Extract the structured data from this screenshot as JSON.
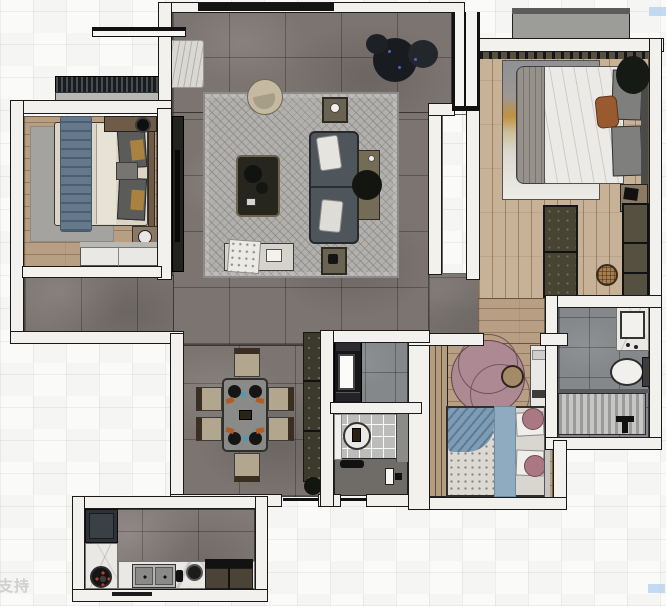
{
  "scene": {
    "type": "apartment floor plan render (top-down)",
    "watermark_text": "支持"
  },
  "colors": {
    "bg_base": "#fafaf9",
    "wall_fill": "#f2f1ee",
    "wall_line": "#1a1a1a",
    "floor_tile": "#7b7470",
    "wood_light": "#c7b298",
    "wood_mid": "#b89e82",
    "rug_gray": "#b2b0ad",
    "rug_bedroom": "#a5a3a0",
    "rug_pink": "#ad8a93",
    "sofa": "#4e565b",
    "bed_cream": "#dcd4c5",
    "bed_white": "#eceae6",
    "blue_textile": "#64798c",
    "blue_light": "#8fabc0",
    "pink_pillow": "#a97883",
    "orange_pillow": "#9a5a30",
    "dark_cabinet": "#22231f",
    "olive_cabinet": "#474433",
    "olive_light": "#55503f",
    "white_furniture": "#e9e8e4",
    "marble": "#eae8e4",
    "fridge": "#2c3237",
    "bath_tile": "#85888b",
    "tile_light": "#bcbcba",
    "shower_a": "#9a9a98",
    "shower_b": "#c6c6c4",
    "balcony": "#9c9c99",
    "plant_dark": "#191c1f",
    "headboard": "#6e5c48",
    "watermark": "#cbcbc9",
    "artifact_blue": "#b9d3ee"
  },
  "rooms": [
    {
      "id": "living-room",
      "floor": "gray marble tile",
      "items": [
        "tv-console",
        "curtain",
        "top-window",
        "herringbone-rug",
        "round-armchair",
        "coffee-table-with-plants",
        "sofa",
        "side-table-with-kettle",
        "side-table",
        "sofa-console",
        "floor-plant",
        "bench-with-throw"
      ]
    },
    {
      "id": "bedroom-left",
      "floor": "wood",
      "items": [
        "double-bed",
        "blue-throw",
        "gray-rug",
        "dark-pillows",
        "overhead-cabinet",
        "round-speaker",
        "nightstand-tray",
        "white-wardrobe",
        "balcony-planter",
        "balcony-slab",
        "window-bar"
      ]
    },
    {
      "id": "bedroom-right",
      "floor": "wood plank",
      "items": [
        "double-bed",
        "white-duvet",
        "gray-throw",
        "orange-pillow",
        "art-rug",
        "nightstand",
        "corner-plant",
        "closet-left",
        "closet-right",
        "rattan-pouf",
        "balcony-slab",
        "curtain-rail"
      ]
    },
    {
      "id": "dining-area",
      "floor": "gray marble tile",
      "items": [
        "dining-table",
        "dining-chair",
        "dining-chair",
        "dining-chair",
        "dining-chair",
        "dining-chair",
        "dining-chair",
        "sideboard",
        "plant"
      ]
    },
    {
      "id": "kitchen",
      "floor": "gray tile",
      "items": [
        "refrigerator",
        "marble-counter-left",
        "marble-counter-bottom",
        "burner",
        "double-sink",
        "faucet",
        "pot",
        "cooktop-bar",
        "base-cabinets",
        "window-line"
      ]
    },
    {
      "id": "bathroom-right",
      "floor": "gray tile",
      "items": [
        "vanity-basin",
        "toilet",
        "shower-floor",
        "shower-fixture"
      ]
    },
    {
      "id": "inner-bathroom",
      "items": [
        "black-vanity",
        "mirror",
        "round-basin",
        "white-door",
        "floor-items",
        "door-handle"
      ]
    },
    {
      "id": "bedroom-bottom",
      "floor": "wood",
      "items": [
        "single-bed",
        "blue-drape",
        "blue-runner",
        "white-pillows",
        "pink-round-pillows",
        "pink-round-rug",
        "round-pouf",
        "slatted-wardrobe",
        "white-cabinet"
      ]
    },
    {
      "id": "hallway",
      "floor": "wood",
      "items": []
    },
    {
      "id": "entry",
      "items": [
        "entry-door-frame"
      ]
    },
    {
      "id": "void-shaft",
      "items": []
    }
  ],
  "artifacts": {
    "blue_patch_top_right": "#b9d3ee",
    "blue_patch_bottom_right": "#b9d3ee"
  }
}
